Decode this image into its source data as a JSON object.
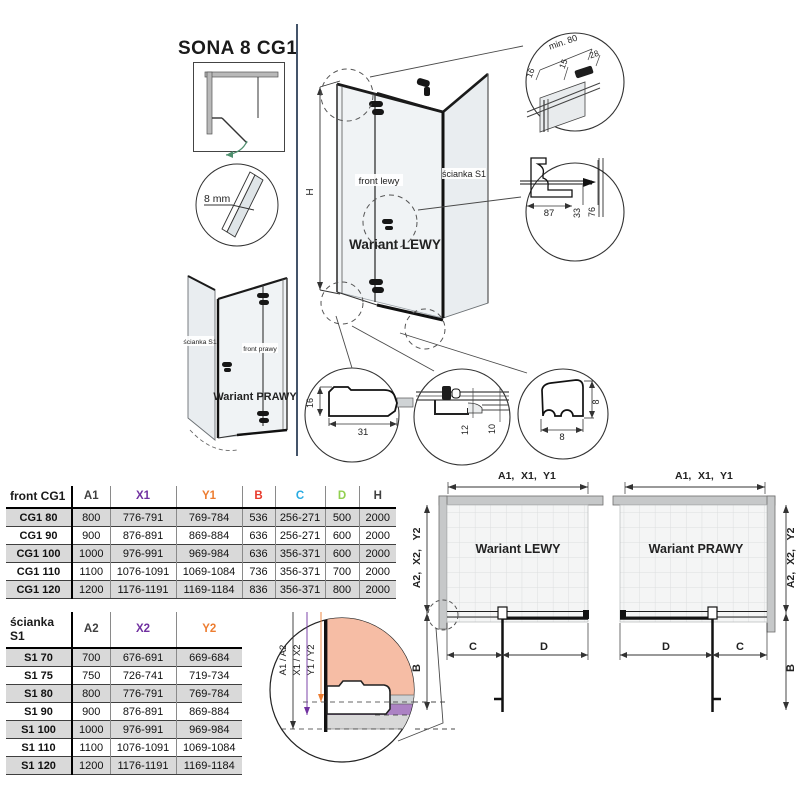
{
  "title": "SONA 8 CG1",
  "colors": {
    "accent_purple": "#7030A0",
    "accent_orange": "#ED7D31",
    "accent_red": "#E8392B",
    "accent_cyan": "#29ABE2",
    "accent_green": "#92D050",
    "divider_navy": "#44546A",
    "salmon_fill": "#F6BDA5",
    "purple_band": "#AC82C4"
  },
  "drawing": {
    "h": "H",
    "thickness": "8 mm",
    "front_left": "front lewy",
    "front_right": "front prawy",
    "wall": "ścianka S1",
    "left_name": "Wariant LEWY",
    "right_name": "Wariant PRAWY"
  },
  "details": {
    "corner": {
      "min": "min. 80",
      "d15": "15",
      "d28": "28",
      "d16": "16"
    },
    "wallprofile": {
      "d87": "87",
      "d33": "33",
      "d76": "76"
    },
    "seal": {
      "d16": "16",
      "d31": "31"
    },
    "rail": {
      "d12": "12",
      "d10": "10"
    },
    "gasket": {
      "dv": "8",
      "dh": "8"
    }
  },
  "plans": {
    "left_name": "Wariant LEWY",
    "right_name": "Wariant PRAWY",
    "dim_a1": "A1,",
    "dim_x1": "X1,",
    "dim_y1": "Y1",
    "dim_a2": "A2,",
    "dim_x2": "X2,",
    "dim_y2": "Y2",
    "dim_b": "B",
    "dim_c": "C",
    "dim_d": "D"
  },
  "section": {
    "a": "A1 / A2",
    "x": "X1 / X2",
    "y": "Y1 / Y2",
    "b": "B"
  },
  "table_front": {
    "header": {
      "label": "front CG1",
      "a1": "A1",
      "x1": "X1",
      "y1": "Y1",
      "b": "B",
      "c": "C",
      "d": "D",
      "h": "H"
    },
    "rows": [
      {
        "label": "CG1 80",
        "a1": "800",
        "x1": "776-791",
        "y1": "769-784",
        "b": "536",
        "c": "256-271",
        "d": "500",
        "h": "2000"
      },
      {
        "label": "CG1 90",
        "a1": "900",
        "x1": "876-891",
        "y1": "869-884",
        "b": "636",
        "c": "256-271",
        "d": "600",
        "h": "2000"
      },
      {
        "label": "CG1 100",
        "a1": "1000",
        "x1": "976-991",
        "y1": "969-984",
        "b": "636",
        "c": "356-371",
        "d": "600",
        "h": "2000"
      },
      {
        "label": "CG1 110",
        "a1": "1100",
        "x1": "1076-1091",
        "y1": "1069-1084",
        "b": "736",
        "c": "356-371",
        "d": "700",
        "h": "2000"
      },
      {
        "label": "CG1 120",
        "a1": "1200",
        "x1": "1176-1191",
        "y1": "1169-1184",
        "b": "836",
        "c": "356-371",
        "d": "800",
        "h": "2000"
      }
    ]
  },
  "table_wall": {
    "header": {
      "label": "ścianka S1",
      "a2": "A2",
      "x2": "X2",
      "y2": "Y2"
    },
    "rows": [
      {
        "label": "S1 70",
        "a2": "700",
        "x2": "676-691",
        "y2": "669-684"
      },
      {
        "label": "S1 75",
        "a2": "750",
        "x2": "726-741",
        "y2": "719-734"
      },
      {
        "label": "S1 80",
        "a2": "800",
        "x2": "776-791",
        "y2": "769-784"
      },
      {
        "label": "S1 90",
        "a2": "900",
        "x2": "876-891",
        "y2": "869-884"
      },
      {
        "label": "S1 100",
        "a2": "1000",
        "x2": "976-991",
        "y2": "969-984"
      },
      {
        "label": "S1 110",
        "a2": "1100",
        "x2": "1076-1091",
        "y2": "1069-1084"
      },
      {
        "label": "S1 120",
        "a2": "1200",
        "x2": "1176-1191",
        "y2": "1169-1184"
      }
    ]
  }
}
